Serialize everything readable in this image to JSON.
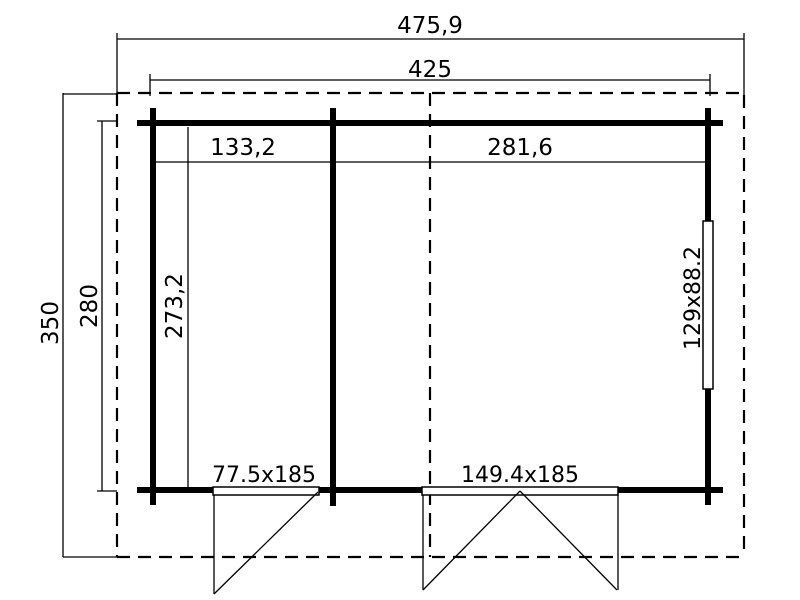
{
  "diagram": {
    "type": "floor-plan",
    "colors": {
      "line": "#000000",
      "background": "#ffffff"
    },
    "dimensions": {
      "outer_width": "475,9",
      "inner_width": "425",
      "outer_depth": "350",
      "inner_depth": "280",
      "room_left_width": "133,2",
      "room_right_width": "281,6",
      "room_depth": "273,2"
    },
    "openings": {
      "door_left": "77.5x185",
      "door_right": "149.4x185",
      "window_right": "129x88.2"
    }
  }
}
